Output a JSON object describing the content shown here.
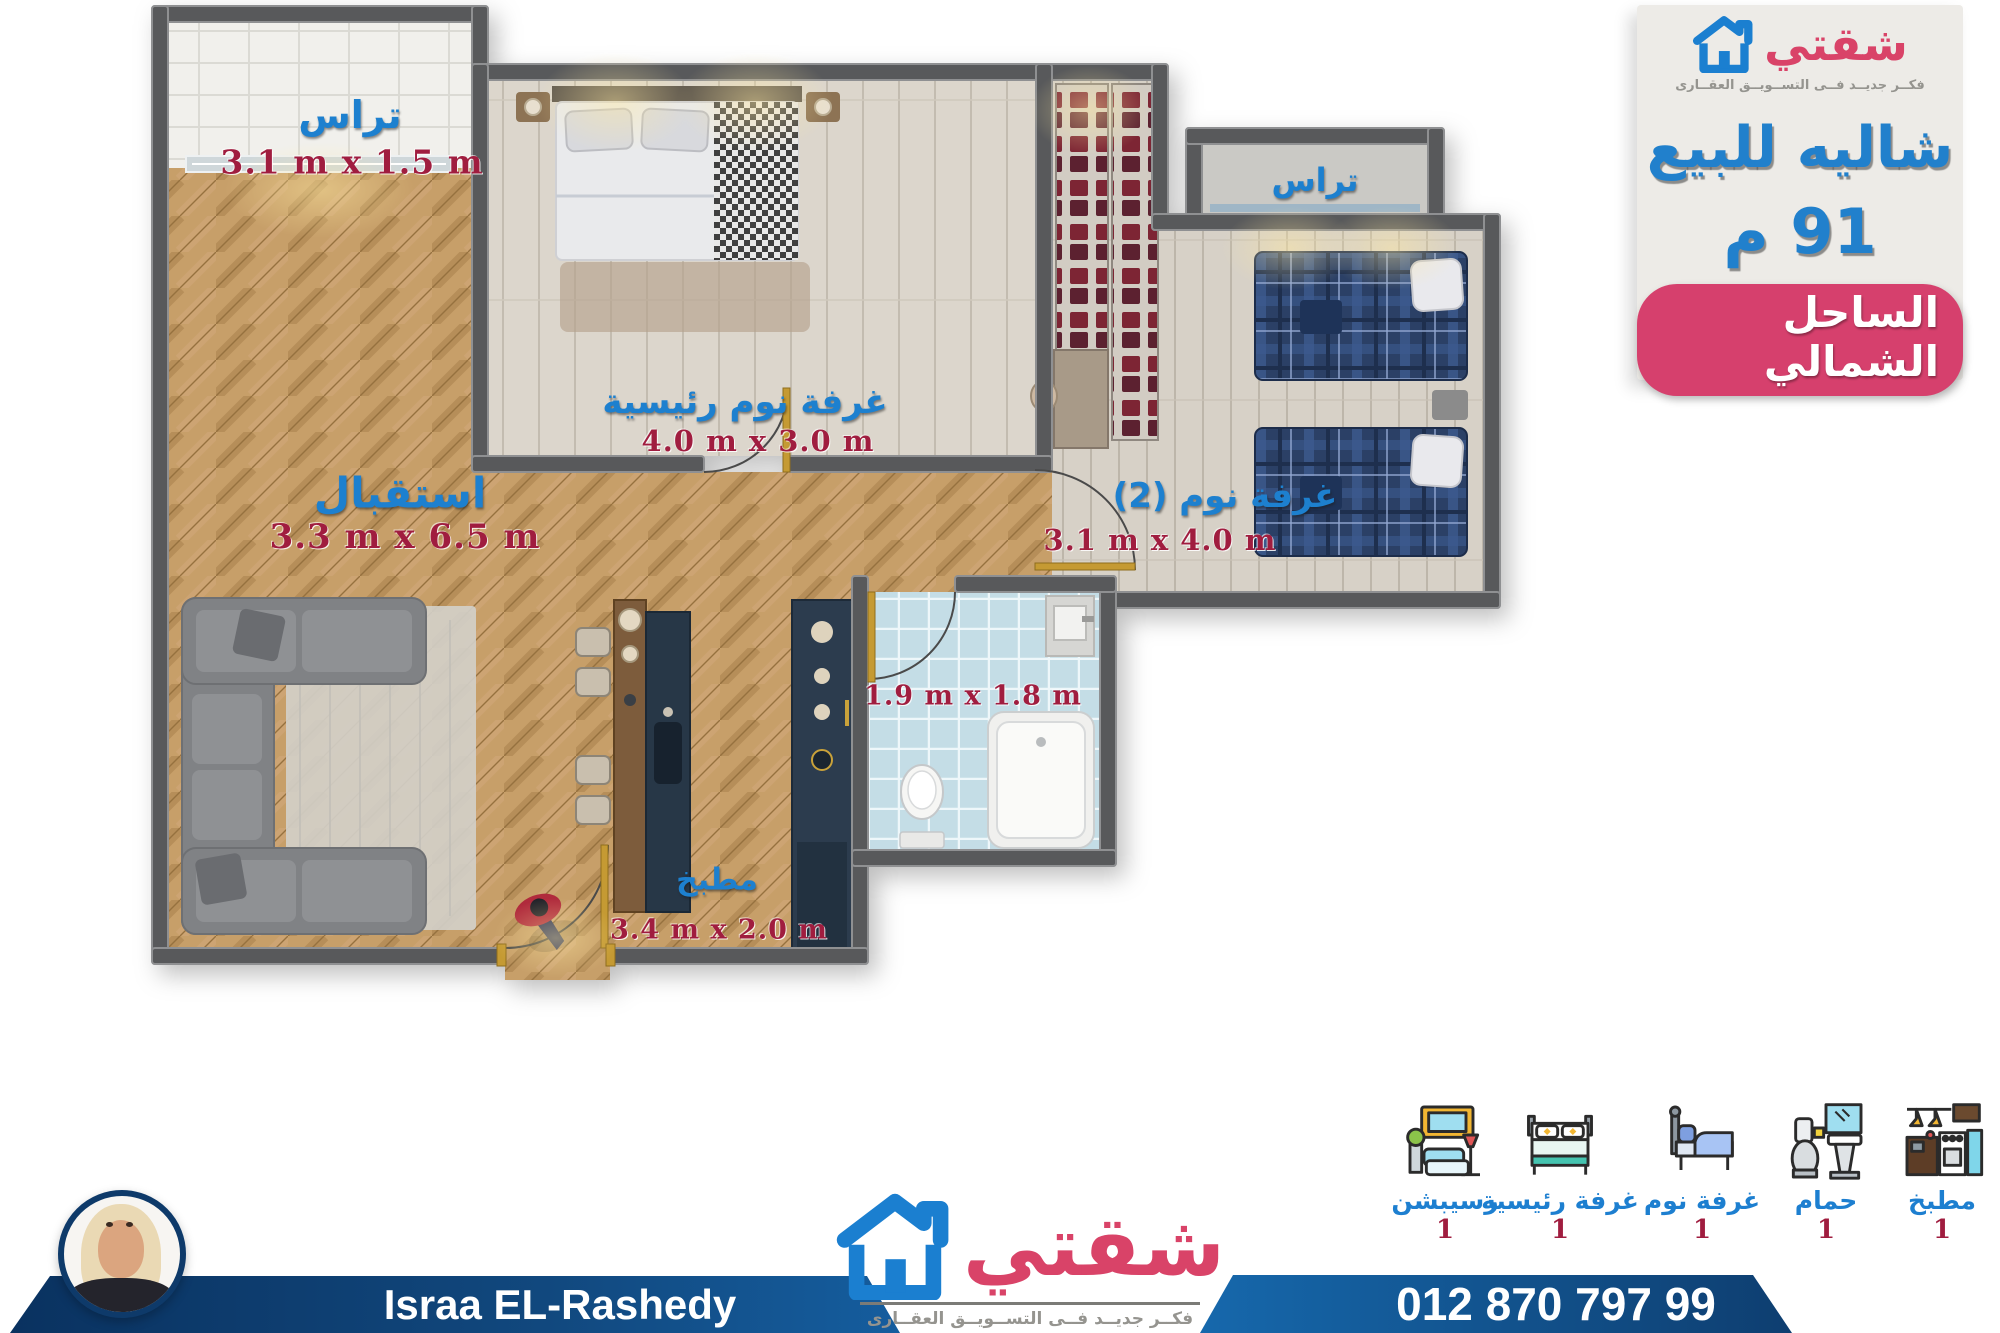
{
  "brand": {
    "name": "شقتي",
    "tagline": "فكــر جديــد فــى التســويــق العقــارى"
  },
  "listing": {
    "title": "شاليه للبيع",
    "area": "91 م",
    "location": "الساحل الشمالي"
  },
  "plan": {
    "terrace_top_left": {
      "label": "تراس",
      "dims": "3.1 m x 1.5 m"
    },
    "master_bedroom": {
      "label": "غرفة نوم رئيسية",
      "dims": "4.0 m x 3.0 m"
    },
    "terrace_top_right": {
      "label": "تراس"
    },
    "bedroom_2": {
      "label": "غرفة نوم (2)",
      "dims": "3.1 m x 4.0 m"
    },
    "reception": {
      "label": "استقبال",
      "dims": "3.3 m x 6.5 m"
    },
    "kitchen": {
      "label": "مطبخ",
      "dims": "3.4 m x 2.0 m"
    },
    "bathroom": {
      "dims": "1.9 m x 1.8 m"
    }
  },
  "legend": [
    {
      "label": "رسيبشن",
      "count": "1",
      "icon": "living-room-icon"
    },
    {
      "label": "غرفة رئيسية",
      "count": "1",
      "icon": "master-bed-icon"
    },
    {
      "label": "غرفة نوم",
      "count": "1",
      "icon": "single-bed-icon"
    },
    {
      "label": "حمام",
      "count": "1",
      "icon": "bathroom-icon"
    },
    {
      "label": "مطبخ",
      "count": "1",
      "icon": "kitchen-icon"
    }
  ],
  "footer": {
    "agent_name": "Israa EL-Rashedy",
    "phone": "012 870 797 99"
  },
  "colors": {
    "accent_blue": "#1d80cf",
    "brand_pink": "#d6406d",
    "dims_red": "#a01d3f",
    "banner_navy": "#0d3a68"
  }
}
